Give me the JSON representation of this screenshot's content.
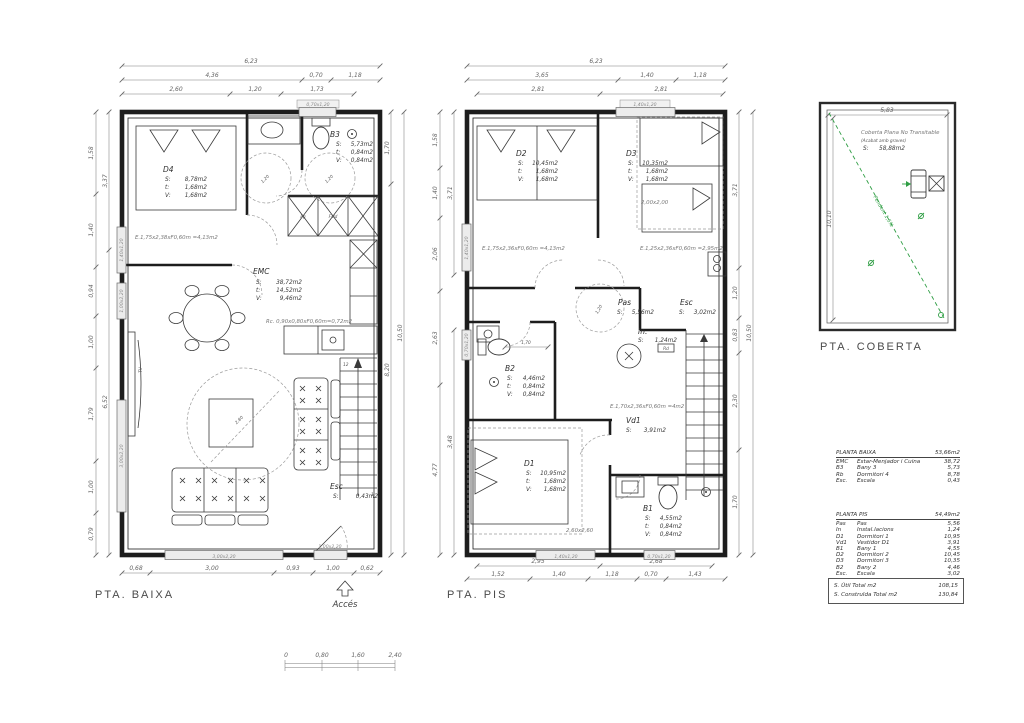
{
  "titles": {
    "baixa": "PTA. BAIXA",
    "pis": "PTA. PIS",
    "coberta": "PTA. COBERTA",
    "acces": "Accés"
  },
  "keys": {
    "s": "S:",
    "t": "t:",
    "v": "V:"
  },
  "baixa": {
    "dims": {
      "w": "6,23",
      "t2": [
        "4,36",
        "0,70",
        "1,18"
      ],
      "t3": [
        "2,60",
        "1,20",
        "1,73"
      ],
      "lo": [
        "1,58",
        "1,40",
        "0,94",
        "1,00",
        "1,79",
        "1,00",
        "0,79"
      ],
      "li": [
        "3,37",
        "6,52"
      ],
      "ri": [
        "1,70",
        "8,20"
      ],
      "ro": "10,50",
      "b": [
        "0,68",
        "3,00",
        "0,93",
        "1,00",
        "0,62"
      ]
    },
    "rooms": {
      "d4": {
        "n": "D4",
        "s": "8,78m2",
        "t": "1,68m2",
        "v": "1,68m2"
      },
      "b3": {
        "n": "B3",
        "s": "5,73m2",
        "t": "0,84m2",
        "v": "0,84m2"
      },
      "emc": {
        "n": "EMC",
        "s": "38,72m2",
        "t": "14,52m2",
        "v": "9,46m2"
      },
      "esc": {
        "n": "Esc",
        "s": "0,43m2"
      }
    },
    "ann": {
      "e1": "E.1,75x2,38xF0,60m =4,13m2",
      "rc": "Rc. 0,90x0,80xF0,60m=0,72m2",
      "fg": "Fg",
      "fsld": "Fsld",
      "tv": "TV",
      "stair_top": "12",
      "stair_bot": "1",
      "c1": "1,20",
      "c2": "1,20",
      "rug": "2,80"
    },
    "openings": {
      "top": "0,70x1,20",
      "l1": "1,40x1,20",
      "l2": "1,00x2,20",
      "l3": "3,00x2,20",
      "b1": "3,00x2,20",
      "b2": "1,00x2,20"
    }
  },
  "pis": {
    "dims": {
      "w": "6,23",
      "t2": [
        "3,65",
        "1,40",
        "1,18"
      ],
      "t3": [
        "2,81",
        "2,81"
      ],
      "lo": [
        "1,58",
        "1,40",
        "2,06",
        "2,63",
        "4,77"
      ],
      "li": [
        "3,71",
        "3,48"
      ],
      "ri": [
        "3,71",
        "1,20",
        "0,83",
        "2,30",
        "1,70"
      ],
      "ro": "10,50",
      "b1": [
        "2,95",
        "2,68"
      ],
      "b2": [
        "1,52",
        "1,40",
        "1,18",
        "0,70",
        "1,43"
      ]
    },
    "rooms": {
      "d2": {
        "n": "D2",
        "s": "10,45m2",
        "t": "1,68m2",
        "v": "1,68m2"
      },
      "d3": {
        "n": "D3",
        "s": "10,35m2",
        "t": "1,68m2",
        "v": "1,68m2"
      },
      "pas": {
        "n": "Pas",
        "s": "5,56m2"
      },
      "esc": {
        "n": "Esc",
        "s": "3,02m2"
      },
      "inst": {
        "n": "In.",
        "s": "1,24m2",
        "rd": "Rd"
      },
      "b2": {
        "n": "B2",
        "s": "4,46m2",
        "t": "0,84m2",
        "v": "0,84m2"
      },
      "vd1": {
        "n": "Vd1",
        "s": "3,91m2"
      },
      "d1": {
        "n": "D1",
        "s": "10,95m2",
        "t": "1,68m2",
        "v": "1,68m2"
      },
      "b1": {
        "n": "B1",
        "s": "4,55m2",
        "t": "0,84m2",
        "v": "0,84m2"
      }
    },
    "ann": {
      "e1": "E.1,75x2,36xF0,60m =4,13m2",
      "e2": "E.1,25x2,36xF0,60m =2,95m2",
      "e3": "E.1,70x2,36xF0,60m =4m2",
      "d3box": "2,00x2,00",
      "d1box": "2,60x2,60",
      "b2dim": "1,70",
      "c1": "1,20"
    },
    "openings": {
      "top": "1,40x1,20",
      "l1": "1,40x1,20",
      "l2": "0,70x1,20",
      "b1": "1,40x1,20",
      "b2": "0,70x1,20"
    }
  },
  "coberta": {
    "line1": "Coberta Plana No Transitable",
    "line2": "(Acabat amb graves)",
    "s": "58,88m2",
    "pendent": "Pendent 1,5%",
    "w": "5,83",
    "h": "10,10"
  },
  "tables": {
    "baixa": {
      "header": "PLANTA BAIXA",
      "total": "53,66m2",
      "rows": [
        [
          "EMC",
          "Estar-Menjador i Cuina",
          "38,72"
        ],
        [
          "B3",
          "Bany 3",
          "5,73"
        ],
        [
          "Rb",
          "Dormitori 4",
          "8,78"
        ],
        [
          "Esc.",
          "Escala",
          "0,43"
        ]
      ]
    },
    "pis": {
      "header": "PLANTA PIS",
      "total": "54,49m2",
      "rows": [
        [
          "Pas",
          "Pas",
          "5,56"
        ],
        [
          "In",
          "Instal.lacions",
          "1,24"
        ],
        [
          "D1",
          "Dormitori 1",
          "10,95"
        ],
        [
          "Vd1",
          "Vestidor D1",
          "3,91"
        ],
        [
          "B1",
          "Bany 1",
          "4,55"
        ],
        [
          "D2",
          "Dormitori 2",
          "10,45"
        ],
        [
          "D3",
          "Dormitori 3",
          "10,35"
        ],
        [
          "B2",
          "Bany 2",
          "4,46"
        ],
        [
          "Esc.",
          "Escala",
          "3,02"
        ]
      ]
    },
    "totals": [
      [
        "S. Útil Total m2",
        "108,15"
      ],
      [
        "S. Construïda Total m2",
        "130,84"
      ]
    ]
  },
  "scalebar": {
    "labels": [
      "0",
      "0,80",
      "1,60",
      "2,40"
    ]
  },
  "colors": {
    "line": "#1d1d1d",
    "dim_text": "#666666",
    "green": "#2f9e44",
    "window_fill": "#ececec"
  }
}
